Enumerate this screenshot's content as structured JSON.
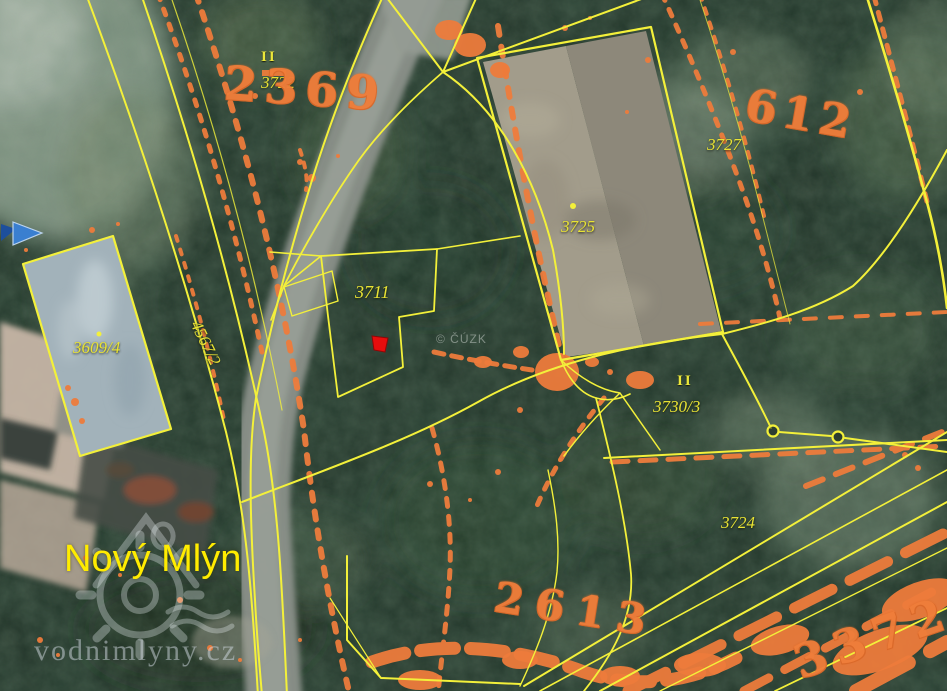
{
  "map": {
    "place": {
      "name": "Nový Mlýn"
    },
    "attribution": {
      "text": "© ČÚZK"
    },
    "watermark": {
      "site": "vodnimlyny.cz"
    },
    "parcels": {
      "p3722": "3722",
      "p3727": "3727",
      "p3725": "3725",
      "p3711": "3711",
      "p3609_4": "3609/4",
      "p4567_2": "4567/2",
      "p3730_3": "3730/3",
      "p3724": "3724"
    },
    "historic_raster_numbers": {
      "r2369": "2369",
      "r612": "612",
      "r2613": "2613",
      "r3372": "3372"
    },
    "symbols": {
      "land_use_marker": "II"
    },
    "colors": {
      "parcel_line": "#f3f03a",
      "parcel_text": "#e9e334",
      "raster_overlay": "#ee7c3c",
      "place_text": "#ffec00",
      "selected_marker": "#e50d0d",
      "nav_arrow": "#3a7fd0"
    }
  }
}
